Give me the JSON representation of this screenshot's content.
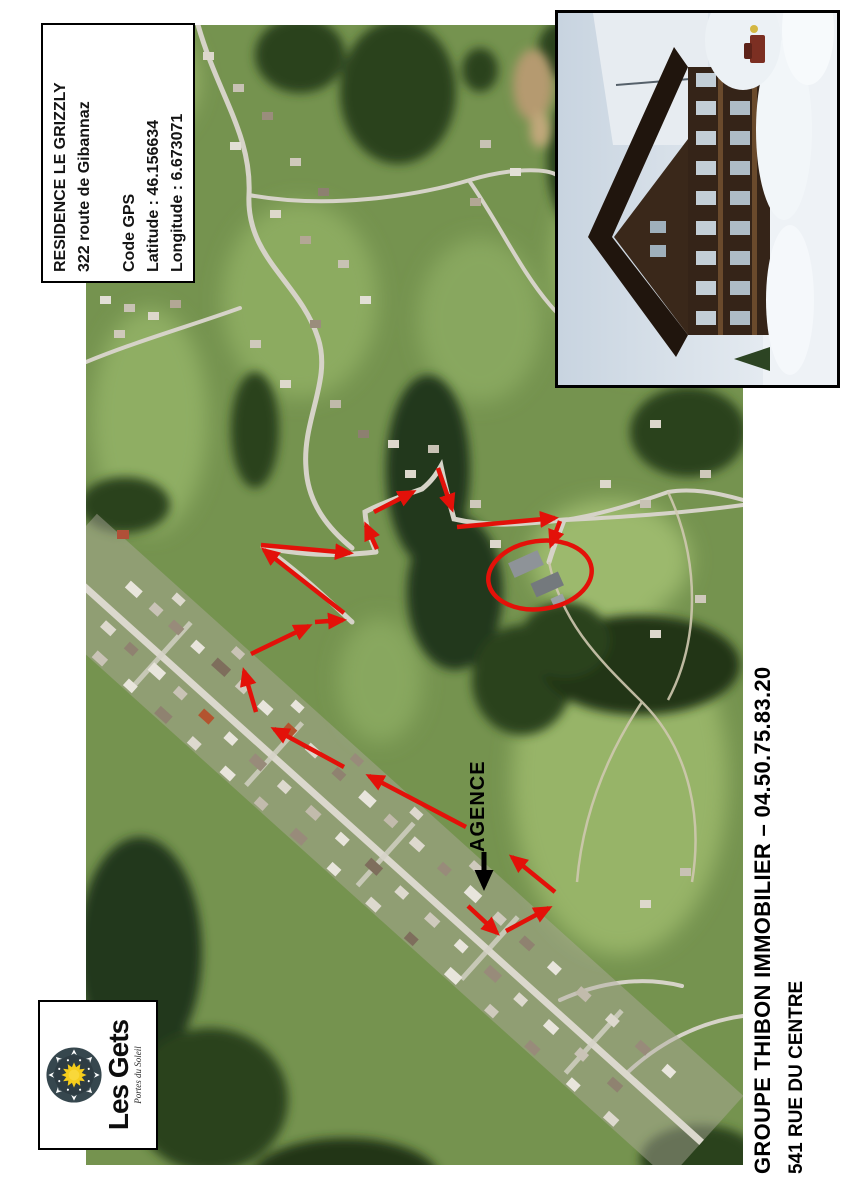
{
  "document": {
    "info_box": {
      "title": "RESIDENCE LE GRIZZLY",
      "address": "322 route de Gibannaz",
      "gps_heading": "Code GPS",
      "latitude_label": "Latitude : 46.156634",
      "longitude_label": "Longitude : 6.673071"
    },
    "map": {
      "agency_label": "AGENCE"
    },
    "logo": {
      "resort_name": "Les Gets",
      "tagline": "Portes du Soleil"
    },
    "footer": {
      "agency_line": "GROUPE THIBON IMMOBILIER – 04.50.75.83.20",
      "address_line": "541 RUE DU CENTRE"
    },
    "colors": {
      "route_arrow": "#e31109",
      "agency_arrow": "#000000",
      "highlight_ellipse": "#e31109"
    }
  }
}
